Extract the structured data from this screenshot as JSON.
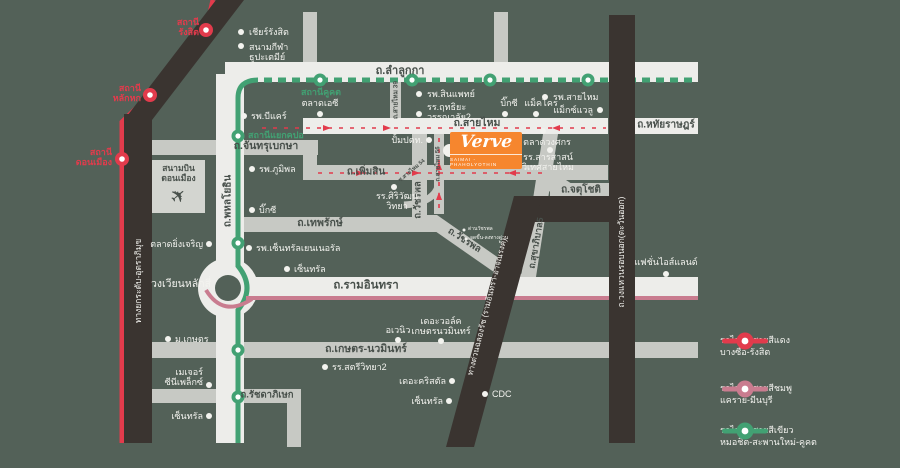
{
  "project": {
    "logo": "Verve",
    "subtitle": "SAIMAI - PHAHOLYOTHIN"
  },
  "airport": {
    "text": "สนามบิน\nดอนเมือง"
  },
  "colors": {
    "background": "#536158",
    "road_white": "#EDEDEA",
    "road_gray": "#C7C9C4",
    "road_black": "#3A3430",
    "red_line": "#E23B4C",
    "pink_line": "#C97C8F",
    "green_line": "#42A173",
    "brand_orange": "#F6862E"
  },
  "legend": {
    "items": [
      {
        "line1": "รถไฟฟ้าสายสีแดง",
        "line2": "บางซื่อ-รังสิต",
        "color": "#E23B4C"
      },
      {
        "line1": "รถไฟฟ้าสายสีชมพู",
        "line2": "แคราย-มีนบุรี",
        "color": "#C97C8F"
      },
      {
        "line1": "รถไฟฟ้าสายสีเขียว",
        "line2": "หมอชิต-สะพานใหม่-คูคต",
        "color": "#42A173"
      }
    ]
  },
  "labels": [
    {
      "n": "road-label-lamlukka",
      "t": "ถ.ลำลูกกา",
      "x": 400,
      "y": 71,
      "c": "dark",
      "fs": 11,
      "a": "c"
    },
    {
      "n": "road-label-hathairat",
      "t": "ถ.หทัยราษฎร์",
      "x": 666,
      "y": 125,
      "c": "dark",
      "fs": 10,
      "a": "c"
    },
    {
      "n": "road-label-saimai",
      "t": "ถ.สายไหม",
      "x": 477,
      "y": 124,
      "c": "dark",
      "fs": 10.5,
      "a": "c"
    },
    {
      "n": "road-label-phoemsin",
      "t": "ถ.เพิ่มสิน",
      "x": 366,
      "y": 172,
      "c": "dark",
      "fs": 10,
      "a": "c"
    },
    {
      "n": "road-label-chanthrubeksa",
      "t": "ถ.จันทรุเบกษา",
      "x": 266,
      "y": 147,
      "c": "dark",
      "fs": 10.5,
      "a": "c"
    },
    {
      "n": "road-label-thepharak",
      "t": "ถ.เทพรักษ์",
      "x": 320,
      "y": 224,
      "c": "dark",
      "fs": 10.5,
      "a": "c"
    },
    {
      "n": "road-label-chatuchot",
      "t": "ถ.จตุโชติ",
      "x": 581,
      "y": 190,
      "c": "dark",
      "fs": 10,
      "a": "c"
    },
    {
      "n": "road-label-ramindra",
      "t": "ถ.รามอินทรา",
      "x": 366,
      "y": 286,
      "c": "dark",
      "fs": 11.5,
      "a": "c"
    },
    {
      "n": "road-label-kaset-nawamin",
      "t": "ถ.เกษตร-นวมินทร์",
      "x": 366,
      "y": 350,
      "c": "dark",
      "fs": 10.5,
      "a": "c"
    },
    {
      "n": "road-label-ratchadaphisek",
      "t": "ถ.รัชดาภิเษก",
      "x": 267,
      "y": 396,
      "c": "dark",
      "fs": 9.5,
      "a": "c"
    },
    {
      "n": "road-label-phahonyothin",
      "t": "ถ.พหลโยธิน",
      "x": 228,
      "y": 201,
      "c": "dark",
      "fs": 10,
      "a": "c",
      "rot": -90
    },
    {
      "n": "road-label-watcharaphon-vertical",
      "t": "ถ.วัชรพล",
      "x": 419,
      "y": 200,
      "c": "dark",
      "fs": 9.5,
      "a": "c",
      "rot": -90
    },
    {
      "n": "road-label-watcharaphon-diagonal",
      "t": "ถ.วัชรพล",
      "x": 464,
      "y": 241,
      "c": "dark",
      "fs": 9.5,
      "a": "c",
      "rot": 33
    },
    {
      "n": "road-label-sukhaphiban5",
      "t": "ถ.สุขาภิบาล5",
      "x": 536,
      "y": 243,
      "c": "dark",
      "fs": 9,
      "a": "c",
      "rot": -80
    },
    {
      "n": "road-label-wongwaen-outer-ring",
      "t": "ถ.วงแหวนรอบนอก(ตะวันออก)",
      "x": 622,
      "y": 252,
      "c": "white",
      "fs": 8.5,
      "a": "c",
      "rot": -90
    },
    {
      "n": "road-label-tollway-uttraphimuk",
      "t": "ทางยกระดับ-อุตราภิมุข",
      "x": 139,
      "y": 281,
      "c": "white",
      "fs": 8.5,
      "a": "c",
      "rot": -90
    },
    {
      "n": "road-label-chalongrat-expressway",
      "t": "ทางด่วนฉลองรัช (รามอินทรา-อาจณรงค์)",
      "x": 488,
      "y": 307,
      "c": "white",
      "fs": 8,
      "a": "c",
      "rot": -76
    },
    {
      "n": "landmark-label-laksi-circle",
      "t": "วงเวียนหลักสี่",
      "x": 181,
      "y": 285,
      "c": "white",
      "fs": 10.5,
      "a": "c"
    },
    {
      "n": "road-label-saimai56",
      "t": "ถ.สายไหม 56",
      "x": 439,
      "y": 164,
      "c": "dark",
      "fs": 6,
      "a": "c",
      "rot": -90
    },
    {
      "n": "road-label-soi-saimai54",
      "t": "ซ.สายไหม 54",
      "x": 412,
      "y": 171,
      "c": "dark",
      "fs": 5.5,
      "a": "c",
      "rot": -40
    },
    {
      "n": "road-label-saimai39",
      "t": "ถ.สายไหม 39",
      "x": 396,
      "y": 100,
      "c": "dark",
      "fs": 6.5,
      "a": "c",
      "rot": -90
    },
    {
      "n": "station-label-rangsit",
      "t": "สถานี\nรังสิต",
      "x": 199,
      "y": 27,
      "c": "red",
      "fs": 9,
      "a": "r"
    },
    {
      "n": "station-label-lakhok",
      "t": "สถานี\nหลักหก",
      "x": 141,
      "y": 93,
      "c": "red",
      "fs": 9,
      "a": "r"
    },
    {
      "n": "station-label-donmueang",
      "t": "สถานี\nดอนเมือง",
      "x": 112,
      "y": 157,
      "c": "red",
      "fs": 9,
      "a": "r"
    },
    {
      "n": "station-label-khukhot",
      "t": "สถานีคูคต",
      "x": 321,
      "y": 92,
      "c": "green2",
      "fs": 9,
      "a": "c"
    },
    {
      "n": "station-label-yaek-kpo",
      "t": "สถานีแยกคปอ",
      "x": 248,
      "y": 135,
      "c": "green2",
      "fs": 9,
      "a": "l"
    },
    {
      "n": "poi-label-zeer-rangsit",
      "t": "เชียร์รังสิต",
      "x": 249,
      "y": 32,
      "c": "white",
      "fs": 9,
      "a": "l"
    },
    {
      "n": "poi-label-thupatemi-stadium",
      "t": "สนามกีฬา\nธูปะเตมีย์",
      "x": 249,
      "y": 52,
      "c": "white",
      "fs": 9,
      "a": "l"
    },
    {
      "n": "poi-label-bcare-hospital",
      "t": "รพ.บีแคร์",
      "x": 251,
      "y": 116,
      "c": "white",
      "fs": 9,
      "a": "l"
    },
    {
      "n": "poi-label-bhumibol-hospital",
      "t": "รพ.ภูมิพล",
      "x": 259,
      "y": 169,
      "c": "white",
      "fs": 9,
      "a": "l"
    },
    {
      "n": "poi-label-bigc-phahon",
      "t": "บิ๊กซี",
      "x": 259,
      "y": 210,
      "c": "white",
      "fs": 9,
      "a": "l"
    },
    {
      "n": "poi-label-yingcharoen-market",
      "t": "ตลาดยิ่งเจริญ",
      "x": 203,
      "y": 244,
      "c": "white",
      "fs": 9,
      "a": "r"
    },
    {
      "n": "poi-label-kasetsart-university",
      "t": "ม.เกษตร",
      "x": 175,
      "y": 339,
      "c": "white",
      "fs": 9,
      "a": "l"
    },
    {
      "n": "poi-label-major-cineplex",
      "t": "เมเจอร์\nซีนีเพล็กซ์",
      "x": 203,
      "y": 377,
      "c": "white",
      "fs": 9,
      "a": "r"
    },
    {
      "n": "poi-label-central-west",
      "t": "เซ็นทรัล",
      "x": 203,
      "y": 416,
      "c": "white",
      "fs": 9,
      "a": "r"
    },
    {
      "n": "poi-label-talad-ac",
      "t": "ตลาดเอซี",
      "x": 320,
      "y": 103,
      "c": "white",
      "fs": 9,
      "a": "c"
    },
    {
      "n": "poi-label-synphaet-hospital",
      "t": "รพ.สินแพทย์",
      "x": 427,
      "y": 94,
      "c": "white",
      "fs": 9,
      "a": "l"
    },
    {
      "n": "poi-label-ritthiyawannalai2",
      "t": "รร.ฤทธิยะ\nวรรณาลัย2",
      "x": 427,
      "y": 112,
      "c": "white",
      "fs": 9,
      "a": "l"
    },
    {
      "n": "poi-label-bigc-saimai",
      "t": "บิ๊กซี",
      "x": 509,
      "y": 103,
      "c": "white",
      "fs": 9,
      "a": "c"
    },
    {
      "n": "poi-label-makro",
      "t": "แม็คโคร",
      "x": 541,
      "y": 103,
      "c": "white",
      "fs": 9,
      "a": "c"
    },
    {
      "n": "poi-label-saimai-hospital",
      "t": "รพ.สายไหม",
      "x": 553,
      "y": 97,
      "c": "white",
      "fs": 9,
      "a": "l"
    },
    {
      "n": "poi-label-maxvalu",
      "t": "แม็กซ์แวลู",
      "x": 593,
      "y": 110,
      "c": "white",
      "fs": 9,
      "a": "r"
    },
    {
      "n": "poi-label-wongsakorn-market",
      "t": "ตลาดวงศกร",
      "x": 547,
      "y": 142,
      "c": "white",
      "fs": 9,
      "a": "c"
    },
    {
      "n": "poi-label-sarasas-witaed-saimai",
      "t": "รร.สารสาสน์\nวิเทศสายไหม",
      "x": 548,
      "y": 162,
      "c": "white",
      "fs": 9,
      "a": "c"
    },
    {
      "n": "poi-label-ptt-station",
      "t": "ปั้มปตท.",
      "x": 423,
      "y": 140,
      "c": "white",
      "fs": 9,
      "a": "r"
    },
    {
      "n": "poi-label-siriwat-wittaya",
      "t": "รร.ศิริวัฒน์\nวิทยา",
      "x": 397,
      "y": 201,
      "c": "white",
      "fs": 9,
      "a": "c"
    },
    {
      "n": "poi-label-central-general-hospital",
      "t": "รพ.เซ็นทรัลเยนเนอรัล",
      "x": 256,
      "y": 248,
      "c": "white",
      "fs": 9,
      "a": "l"
    },
    {
      "n": "poi-label-central-ramindra",
      "t": "เซ็นทรัล",
      "x": 294,
      "y": 269,
      "c": "white",
      "fs": 9,
      "a": "l"
    },
    {
      "n": "poi-label-fashion-island",
      "t": "แฟชั่นไอส์แลนด์",
      "x": 666,
      "y": 262,
      "c": "white",
      "fs": 9,
      "a": "c"
    },
    {
      "n": "poi-label-the-walk",
      "t": "เดอะวอล์ค\nเกษตรนวมินทร์",
      "x": 441,
      "y": 326,
      "c": "white",
      "fs": 9,
      "a": "c"
    },
    {
      "n": "poi-label-avenue",
      "t": "อเวนิว",
      "x": 398,
      "y": 330,
      "c": "white",
      "fs": 9,
      "a": "c"
    },
    {
      "n": "poi-label-satriwittaya2",
      "t": "รร.สตรีวิทยา2",
      "x": 332,
      "y": 367,
      "c": "white",
      "fs": 9,
      "a": "l"
    },
    {
      "n": "poi-label-the-crystal",
      "t": "เดอะคริสตัล",
      "x": 446,
      "y": 381,
      "c": "white",
      "fs": 9,
      "a": "r"
    },
    {
      "n": "poi-label-central-south",
      "t": "เซ็นทรัล",
      "x": 443,
      "y": 401,
      "c": "white",
      "fs": 9,
      "a": "r"
    },
    {
      "n": "poi-label-cdc",
      "t": "CDC",
      "x": 492,
      "y": 394,
      "c": "white",
      "fs": 9,
      "a": "l"
    },
    {
      "n": "poi-label-watcharaphon-toll",
      "t": "ด่านวัชรพล",
      "x": 468,
      "y": 230,
      "c": "white",
      "fs": 5,
      "a": "l"
    },
    {
      "n": "poi-label-expressway-ramp",
      "t": "จุดขึ้น-ลงทางด่วน",
      "x": 470,
      "y": 239,
      "c": "white",
      "fs": 5,
      "a": "l"
    }
  ],
  "dots": [
    {
      "n": "poi-dot-zeer-rangsit",
      "x": 241,
      "y": 32
    },
    {
      "n": "poi-dot-thupatemi-stadium",
      "x": 241,
      "y": 46
    },
    {
      "n": "poi-dot-bcare-hospital",
      "x": 244,
      "y": 116
    },
    {
      "n": "poi-dot-bhumibol-hospital",
      "x": 252,
      "y": 169
    },
    {
      "n": "poi-dot-bigc-phahon",
      "x": 252,
      "y": 210
    },
    {
      "n": "poi-dot-yingcharoen-market",
      "x": 209,
      "y": 244
    },
    {
      "n": "poi-dot-kasetsart-university",
      "x": 168,
      "y": 339
    },
    {
      "n": "poi-dot-major-cineplex",
      "x": 209,
      "y": 385
    },
    {
      "n": "poi-dot-central-west",
      "x": 209,
      "y": 416
    },
    {
      "n": "poi-dot-talad-ac",
      "x": 320,
      "y": 114
    },
    {
      "n": "poi-dot-synphaet-hospital",
      "x": 419,
      "y": 94
    },
    {
      "n": "poi-dot-ritthiyawannalai2",
      "x": 419,
      "y": 114
    },
    {
      "n": "poi-dot-bigc-saimai",
      "x": 505,
      "y": 114
    },
    {
      "n": "poi-dot-makro",
      "x": 536,
      "y": 114
    },
    {
      "n": "poi-dot-saimai-hospital",
      "x": 545,
      "y": 97
    },
    {
      "n": "poi-dot-maxvalu",
      "x": 600,
      "y": 110
    },
    {
      "n": "poi-dot-wongsakorn-market",
      "x": 543,
      "y": 131
    },
    {
      "n": "poi-dot-sarasas-witaed-saimai",
      "x": 550,
      "y": 150
    },
    {
      "n": "poi-dot-ptt-station",
      "x": 429,
      "y": 140
    },
    {
      "n": "poi-dot-siriwat-wittaya",
      "x": 394,
      "y": 187
    },
    {
      "n": "poi-dot-central-general-hospital",
      "x": 249,
      "y": 248
    },
    {
      "n": "poi-dot-central-ramindra",
      "x": 287,
      "y": 269
    },
    {
      "n": "poi-dot-fashion-island",
      "x": 666,
      "y": 274
    },
    {
      "n": "poi-dot-the-walk",
      "x": 441,
      "y": 341
    },
    {
      "n": "poi-dot-avenue",
      "x": 398,
      "y": 340
    },
    {
      "n": "poi-dot-satriwittaya2",
      "x": 325,
      "y": 367
    },
    {
      "n": "poi-dot-the-crystal",
      "x": 452,
      "y": 381
    },
    {
      "n": "poi-dot-central-south",
      "x": 449,
      "y": 401
    },
    {
      "n": "poi-dot-cdc",
      "x": 485,
      "y": 394
    },
    {
      "n": "poi-dot-watcharaphon-toll",
      "x": 464,
      "y": 230,
      "s": 3
    },
    {
      "n": "poi-dot-expressway-ramp",
      "x": 466,
      "y": 239,
      "s": 3
    }
  ]
}
